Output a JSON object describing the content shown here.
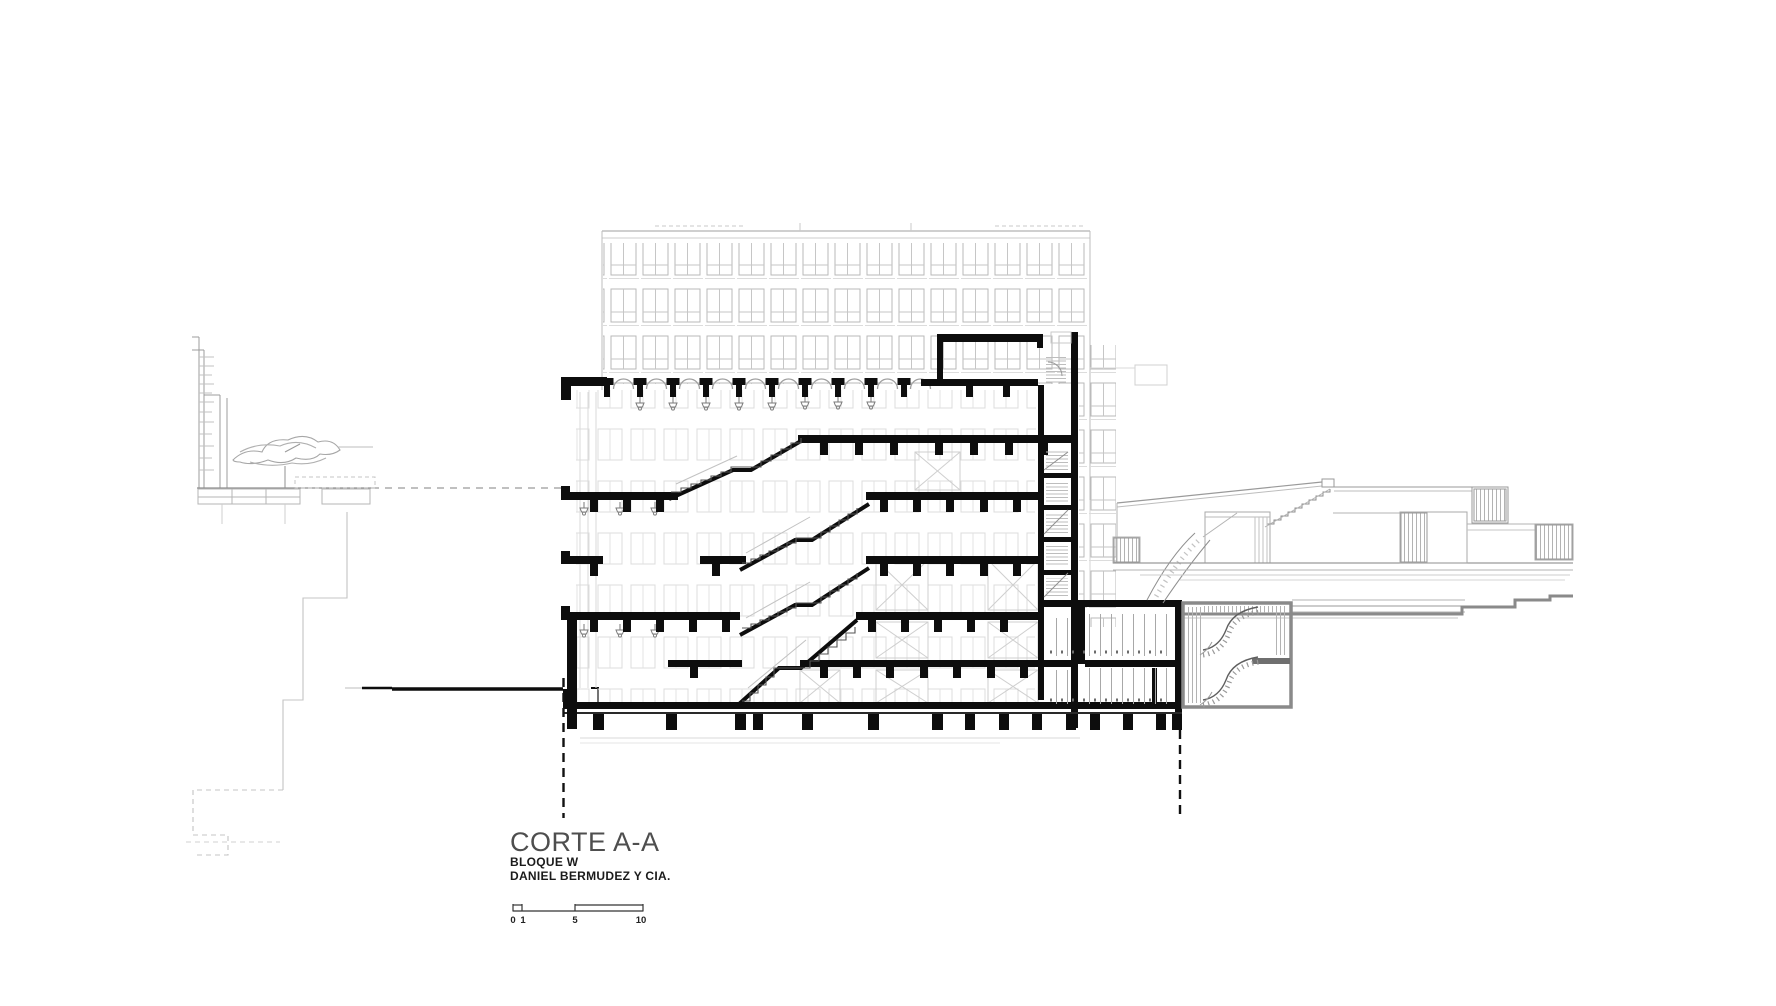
{
  "title_block": {
    "title": "CORTE A-A",
    "block_label": "BLOQUE W",
    "firm_label": "DANIEL BERMUDEZ Y CIA."
  },
  "scale_bar": {
    "labels": [
      "0",
      "1",
      "5",
      "10"
    ]
  },
  "drawing": {
    "type": "architectural-section",
    "section_name": "A-A",
    "building": "Bloque W",
    "colors": {
      "cut_lines": "#0d0d0d",
      "beyond_lines": "#d9d9d9",
      "background_elevation": "#b9b9b9",
      "context_lines": "#9a9a9a",
      "deck_gray": "#8a8a8a",
      "title_gray": "#4e4e4e"
    }
  }
}
